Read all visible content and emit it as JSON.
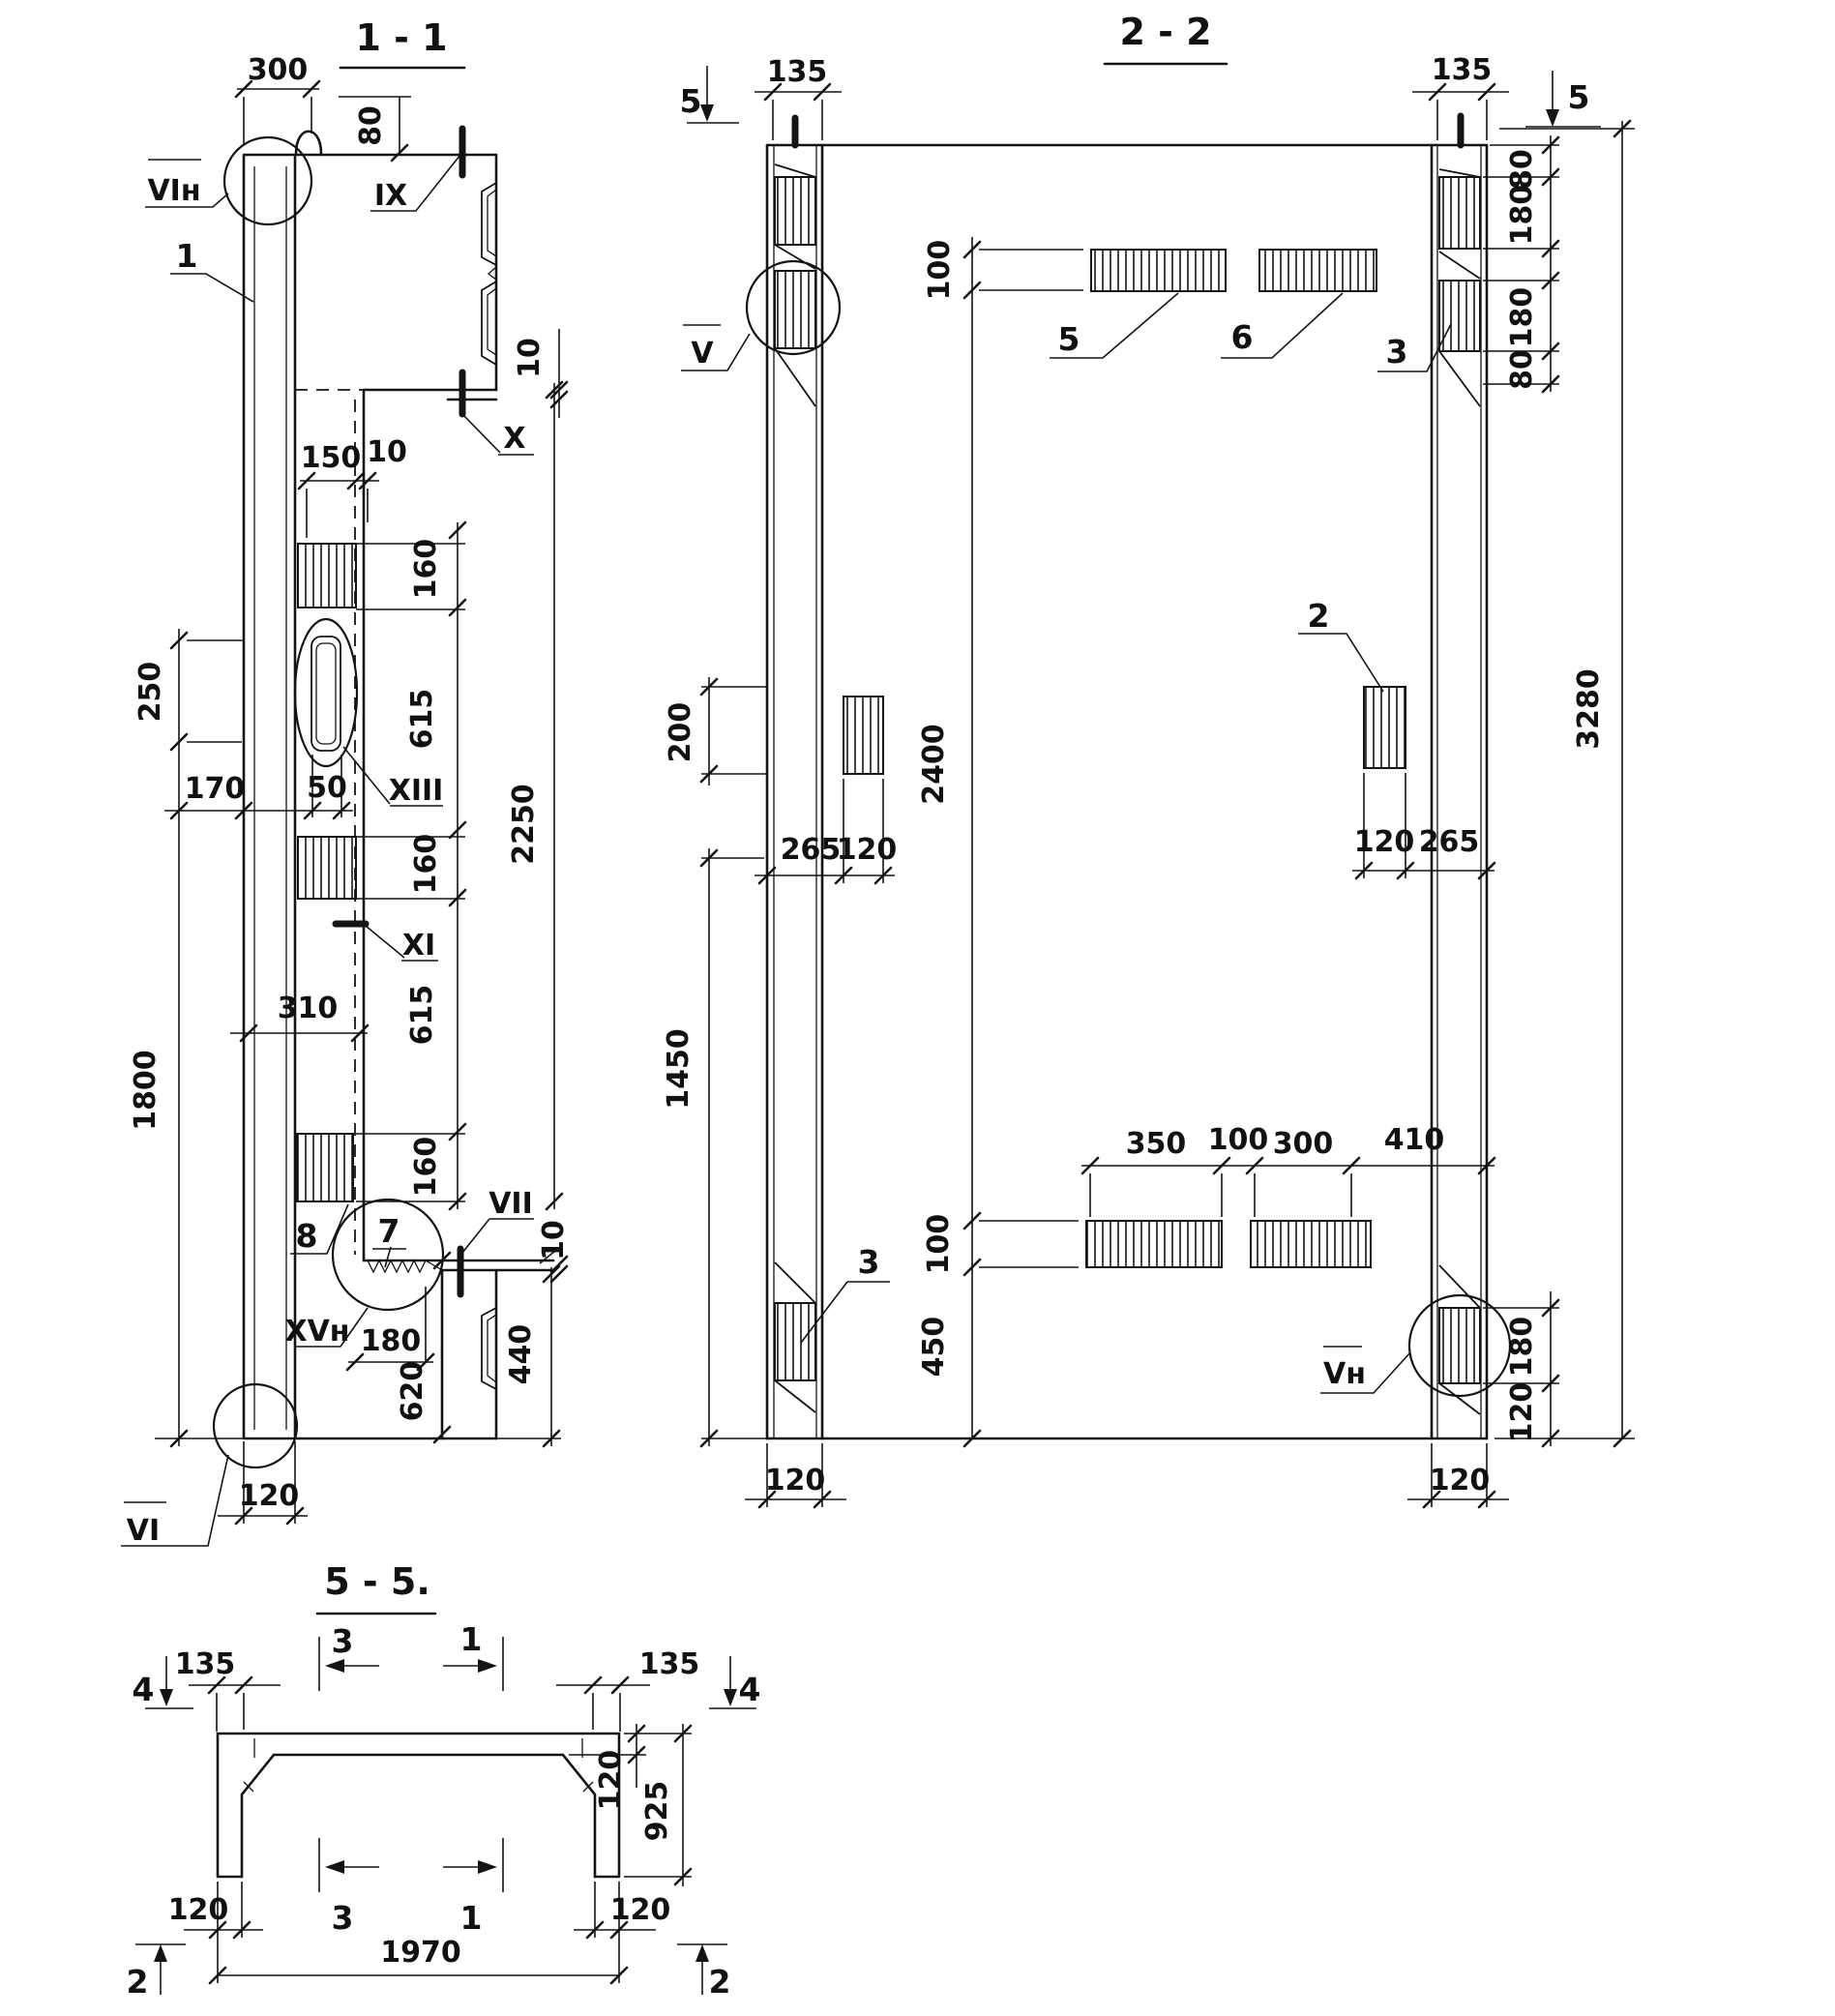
{
  "page": {
    "background": "#ffffff",
    "ink": "#141414"
  },
  "s11": {
    "title": "1 - 1",
    "dims": {
      "d300": "300",
      "d80": "80",
      "d10a": "10",
      "d150": "150",
      "d10b": "10",
      "c160a": "160",
      "c615a": "615",
      "c160b": "160",
      "c615b": "615",
      "c160c": "160",
      "d2250": "2250",
      "d250": "250",
      "d1800": "1800",
      "d170": "170",
      "d50": "50",
      "d310": "310",
      "d180": "180",
      "d620": "620",
      "d440": "440",
      "d10c": "10",
      "d120": "120"
    },
    "marks": {
      "vin": "VIн",
      "ix": "IX",
      "x": "X",
      "xiii": "XIII",
      "xi": "XI",
      "vii": "VII",
      "xvn": "XVн",
      "vi": "VI"
    },
    "callouts": {
      "c1": "1",
      "c7": "7",
      "c8": "8"
    }
  },
  "s22": {
    "title": "2 - 2",
    "dims": {
      "d135l": "135",
      "d135r": "135",
      "d80a": "80",
      "d180a": "180",
      "d180b": "180",
      "d80b": "80",
      "d3280": "3280",
      "d100a": "100",
      "d200": "200",
      "d2400": "2400",
      "d265l": "265",
      "d120a": "120",
      "d120b": "120",
      "d265r": "265",
      "d1450": "1450",
      "d350": "350",
      "d100b": "100",
      "d300": "300",
      "d410": "410",
      "d100c": "100",
      "d450": "450",
      "d180c": "180",
      "d120c": "120",
      "d120d": "120",
      "d120e": "120"
    },
    "marks": {
      "v": "V",
      "vn": "Vн"
    },
    "callouts": {
      "c2": "2",
      "c3a": "3",
      "c3b": "3",
      "c5": "5",
      "c6": "6",
      "a5l": "5",
      "a5r": "5"
    }
  },
  "s55": {
    "title": "5 - 5.",
    "dims": {
      "d135l": "135",
      "d135r": "135",
      "d120a": "120",
      "d925": "925",
      "d120b": "120",
      "d120c": "120",
      "d1970": "1970"
    },
    "arrows": {
      "a4l": "4",
      "a4r": "4",
      "a3a": "3",
      "a1a": "1",
      "a3b": "3",
      "a1b": "1",
      "a2l": "2",
      "a2r": "2"
    }
  }
}
